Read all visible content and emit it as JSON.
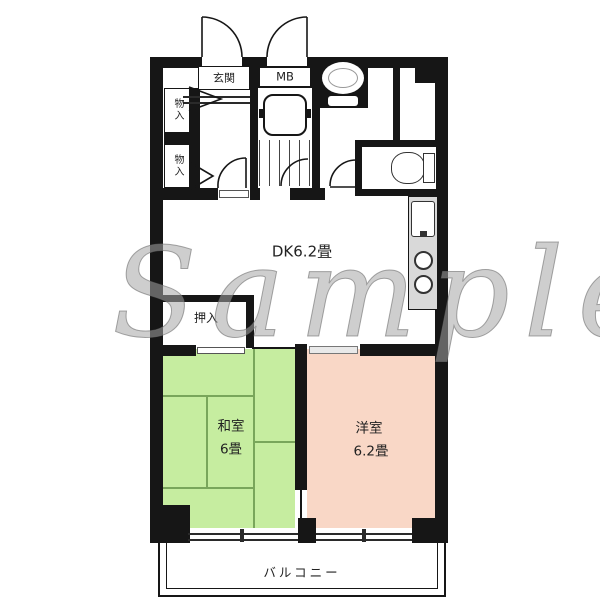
{
  "watermark": "Sample",
  "labels": {
    "entrance": "玄関",
    "meter_box": "MB",
    "storage_upper": "物入",
    "storage_lower": "物入",
    "dining_kitchen": "DK6.2畳",
    "closet": "押入",
    "japanese_room_name": "和室",
    "japanese_room_size": "6畳",
    "western_room_name": "洋室",
    "western_room_size": "6.2畳",
    "balcony": "バルコニー"
  },
  "icons": [
    "bathtub-icon",
    "wash-basin-icon",
    "toilet-icon",
    "kitchen-sink-icon",
    "stove-burners-icon",
    "door-swing-icon",
    "sliding-door-icon",
    "sliding-window-icon",
    "tatami-grid-icon",
    "entrance-step-arrow-icon"
  ],
  "colors": {
    "wall": "#161616",
    "japanese_room_green": "#c6eda0",
    "western_room_pink": "#f9d7c6",
    "kitchen_counter_gray": "#d9d9d9",
    "tatami_line": "#79a65b",
    "label_text": "#222222",
    "watermark_gray": "#a5a5a5"
  }
}
